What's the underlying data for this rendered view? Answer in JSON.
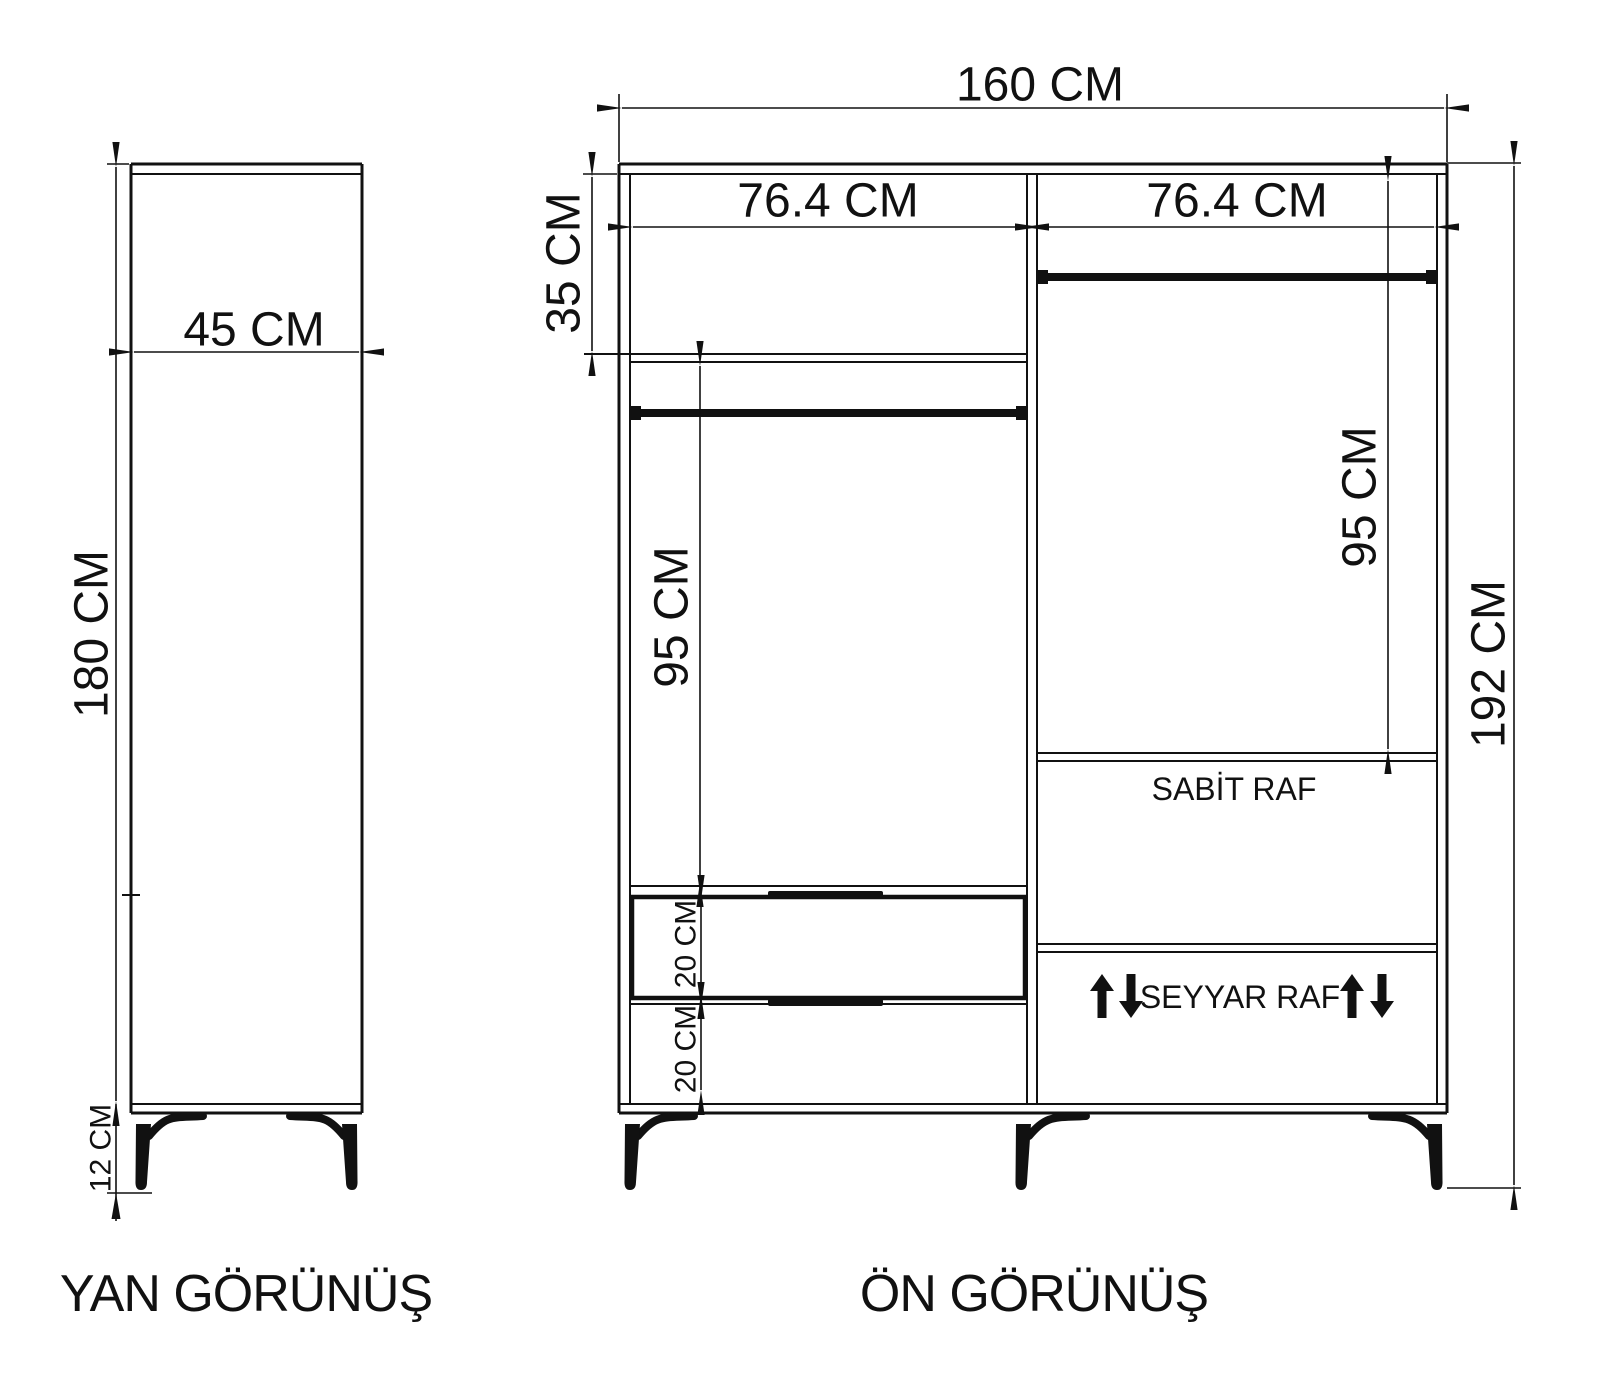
{
  "colors": {
    "line": "#111111",
    "background": "#ffffff"
  },
  "side_view": {
    "title": "YAN GÖRÜNÜŞ",
    "depth_label": "45 CM",
    "height_label": "180 CM",
    "leg_height_label": "12 CM"
  },
  "front_view": {
    "title": "ÖN GÖRÜNÜŞ",
    "width_label": "160 CM",
    "height_label": "192 CM",
    "left_section_width_label": "76.4 CM",
    "right_section_width_label": "76.4 CM",
    "top_shelf_label": "35 CM",
    "left_hanging_label": "95 CM",
    "right_hanging_label": "95 CM",
    "drawer_top_label": "20 CM",
    "drawer_bottom_label": "20 CM",
    "fixed_shelf_label": "SABİT RAF",
    "movable_shelf_label": "SEYYAR RAF"
  }
}
